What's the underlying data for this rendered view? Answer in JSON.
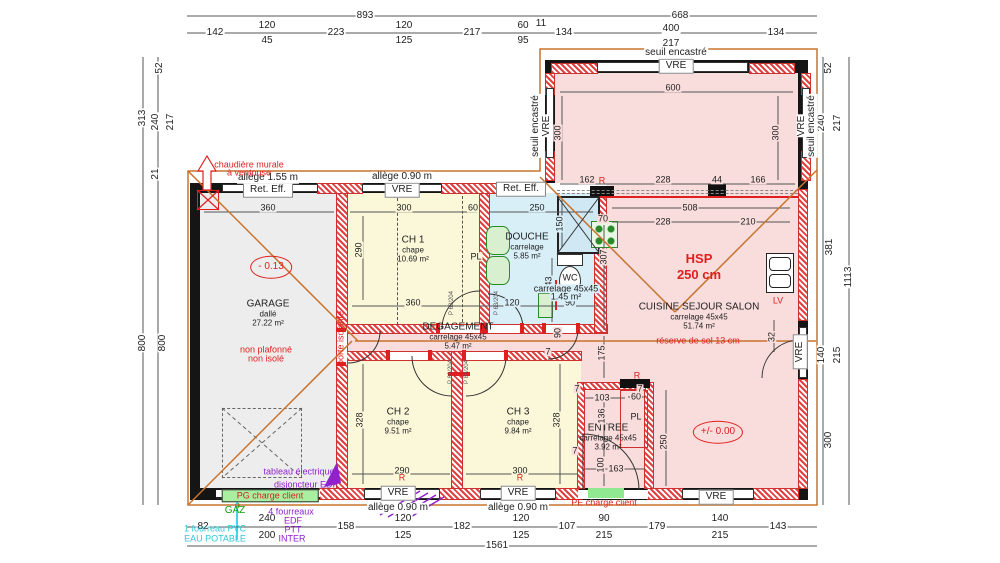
{
  "colors": {
    "wall": "#151515",
    "roof_line": "#c8732d",
    "annotation_red": "#e02020",
    "annotation_purple": "#9020d0",
    "annotation_cyan": "#30c8d8",
    "annotation_green": "#10a010",
    "floor_garage": "#ededed",
    "floor_bedroom": "#fbf7d9",
    "floor_bath": "#d9eff8",
    "floor_living": "#f9dcdc"
  },
  "rooms": [
    {
      "name": "GARAGE",
      "sub": "dallé",
      "area": "27.22 m²",
      "x": 268,
      "y": 313
    },
    {
      "name": "CH 1",
      "sub": "chape",
      "area": "10.69 m²",
      "x": 413,
      "y": 249
    },
    {
      "name": "DOUCHE",
      "sub": "carrelage",
      "area": "5.85 m²",
      "x": 527,
      "y": 246
    },
    {
      "name": "DEGAGEMENT",
      "sub": "carrelage 45x45",
      "area": "5.47 m²",
      "x": 458,
      "y": 336
    },
    {
      "name": "CH 2",
      "sub": "chape",
      "area": "9.51 m²",
      "x": 398,
      "y": 421
    },
    {
      "name": "CH 3",
      "sub": "chape",
      "area": "9.84 m²",
      "x": 518,
      "y": 421
    },
    {
      "name": "ENTREE",
      "sub": "carrelage 45x45",
      "area": "3.92 m²",
      "x": 608,
      "y": 437
    },
    {
      "name": "CUISINE SEJOUR SALON",
      "sub": "carrelage 45x45",
      "area": "51.74 m²",
      "x": 699,
      "y": 316
    }
  ],
  "labels": [
    {
      "t": "893",
      "x": 365,
      "y": 16
    },
    {
      "t": "668",
      "x": 680,
      "y": 16
    },
    {
      "t": "142",
      "x": 215,
      "y": 33
    },
    {
      "t": "120",
      "x": 267,
      "y": 26
    },
    {
      "t": "45",
      "x": 267,
      "y": 41
    },
    {
      "t": "223",
      "x": 336,
      "y": 33
    },
    {
      "t": "120",
      "x": 404,
      "y": 26
    },
    {
      "t": "125",
      "x": 404,
      "y": 41
    },
    {
      "t": "217",
      "x": 472,
      "y": 33
    },
    {
      "t": "60",
      "x": 523,
      "y": 26
    },
    {
      "t": "95",
      "x": 523,
      "y": 41
    },
    {
      "t": "11",
      "x": 541,
      "y": 24
    },
    {
      "t": "134",
      "x": 564,
      "y": 33
    },
    {
      "t": "400",
      "x": 671,
      "y": 29
    },
    {
      "t": "217",
      "x": 671,
      "y": 44
    },
    {
      "t": "134",
      "x": 776,
      "y": 33
    },
    {
      "t": "313",
      "x": 143,
      "y": 118,
      "r": -90
    },
    {
      "t": "800",
      "x": 143,
      "y": 343,
      "r": -90
    },
    {
      "t": "52",
      "x": 160,
      "y": 68,
      "r": -90
    },
    {
      "t": "240",
      "x": 156,
      "y": 122,
      "r": -90
    },
    {
      "t": "217",
      "x": 171,
      "y": 122,
      "r": -90
    },
    {
      "t": "21",
      "x": 156,
      "y": 174,
      "r": -90
    },
    {
      "t": "800",
      "x": 163,
      "y": 343,
      "r": -90
    },
    {
      "t": "52",
      "x": 829,
      "y": 68,
      "r": -90
    },
    {
      "t": "240",
      "x": 822,
      "y": 123,
      "r": -90
    },
    {
      "t": "217",
      "x": 838,
      "y": 123,
      "r": -90
    },
    {
      "t": "381",
      "x": 830,
      "y": 247,
      "r": -90
    },
    {
      "t": "140",
      "x": 822,
      "y": 355,
      "r": -90
    },
    {
      "t": "215",
      "x": 838,
      "y": 355,
      "r": -90
    },
    {
      "t": "300",
      "x": 829,
      "y": 440,
      "r": -90
    },
    {
      "t": "1113",
      "x": 849,
      "y": 277,
      "r": -90
    },
    {
      "t": "82",
      "x": 203,
      "y": 527
    },
    {
      "t": "240",
      "x": 267,
      "y": 519
    },
    {
      "t": "200",
      "x": 267,
      "y": 536
    },
    {
      "t": "158",
      "x": 346,
      "y": 527
    },
    {
      "t": "120",
      "x": 403,
      "y": 519
    },
    {
      "t": "125",
      "x": 403,
      "y": 536
    },
    {
      "t": "182",
      "x": 462,
      "y": 527
    },
    {
      "t": "120",
      "x": 521,
      "y": 519
    },
    {
      "t": "125",
      "x": 521,
      "y": 536
    },
    {
      "t": "107",
      "x": 567,
      "y": 527
    },
    {
      "t": "90",
      "x": 604,
      "y": 519
    },
    {
      "t": "215",
      "x": 604,
      "y": 536
    },
    {
      "t": "179",
      "x": 657,
      "y": 527
    },
    {
      "t": "140",
      "x": 720,
      "y": 519
    },
    {
      "t": "215",
      "x": 720,
      "y": 536
    },
    {
      "t": "143",
      "x": 778,
      "y": 527
    },
    {
      "t": "1561",
      "x": 497,
      "y": 546
    },
    {
      "t": "360",
      "x": 268,
      "y": 208,
      "c": "lb di bgg"
    },
    {
      "t": "300",
      "x": 404,
      "y": 208,
      "c": "lb di bgy"
    },
    {
      "t": "60",
      "x": 473,
      "y": 208,
      "c": "lb di bgy"
    },
    {
      "t": "250",
      "x": 537,
      "y": 208,
      "c": "lb di bgb"
    },
    {
      "t": "70",
      "x": 603,
      "y": 219,
      "c": "lb di bgp"
    },
    {
      "t": "290",
      "x": 359,
      "y": 250,
      "r": -90,
      "c": "lb di bgy"
    },
    {
      "t": "150",
      "x": 560,
      "y": 224,
      "r": -90,
      "c": "lb di bgb"
    },
    {
      "t": "307",
      "x": 604,
      "y": 257,
      "r": -90,
      "c": "lb di bgp"
    },
    {
      "t": "143",
      "x": 549,
      "y": 284,
      "r": -90,
      "c": "lb di bgb"
    },
    {
      "t": "120",
      "x": 512,
      "y": 303,
      "c": "lb di bgb"
    },
    {
      "t": "360",
      "x": 413,
      "y": 303,
      "c": "lb di bgy"
    },
    {
      "t": "90",
      "x": 570,
      "y": 303,
      "c": "lb di bgb"
    },
    {
      "t": "90",
      "x": 558,
      "y": 333,
      "r": -90,
      "c": "lb di bgp"
    },
    {
      "t": "175",
      "x": 602,
      "y": 353,
      "r": -90,
      "c": "lb di bgp"
    },
    {
      "t": "600",
      "x": 673,
      "y": 88,
      "c": "lb di bgp"
    },
    {
      "t": "300",
      "x": 558,
      "y": 133,
      "r": -90,
      "c": "lb di bgp"
    },
    {
      "t": "300",
      "x": 776,
      "y": 133,
      "r": -90,
      "c": "lb di bgp"
    },
    {
      "t": "162",
      "x": 587,
      "y": 180,
      "c": "lb di bgp"
    },
    {
      "t": "228",
      "x": 663,
      "y": 180,
      "c": "lb di bgp"
    },
    {
      "t": "44",
      "x": 717,
      "y": 180,
      "c": "lb di bgp"
    },
    {
      "t": "166",
      "x": 758,
      "y": 180,
      "c": "lb di bgp"
    },
    {
      "t": "508",
      "x": 690,
      "y": 208,
      "c": "lb di bgp"
    },
    {
      "t": "228",
      "x": 663,
      "y": 222,
      "c": "lb di bgp"
    },
    {
      "t": "210",
      "x": 748,
      "y": 222,
      "c": "lb di bgp"
    },
    {
      "t": "328",
      "x": 360,
      "y": 420,
      "r": -90,
      "c": "lb di bgy"
    },
    {
      "t": "290",
      "x": 402,
      "y": 471,
      "c": "lb di bgy"
    },
    {
      "t": "328",
      "x": 557,
      "y": 420,
      "r": -90,
      "c": "lb di bgy"
    },
    {
      "t": "300",
      "x": 520,
      "y": 471,
      "c": "lb di bgy"
    },
    {
      "t": "103",
      "x": 602,
      "y": 398,
      "c": "lb di bgp"
    },
    {
      "t": "60",
      "x": 636,
      "y": 397,
      "c": "lb di bgp"
    },
    {
      "t": "136",
      "x": 602,
      "y": 416,
      "r": -90,
      "c": "lb di bgp"
    },
    {
      "t": "250",
      "x": 664,
      "y": 442,
      "r": -90,
      "c": "lb di bgp"
    },
    {
      "t": "100",
      "x": 601,
      "y": 465,
      "r": -90,
      "c": "lb di bgp"
    },
    {
      "t": "163",
      "x": 616,
      "y": 469,
      "c": "lb di bgp"
    },
    {
      "t": "32",
      "x": 772,
      "y": 337,
      "r": -90,
      "c": "lb di bgp"
    },
    {
      "t": "7",
      "x": 577,
      "y": 389,
      "c": "lb di bgp"
    },
    {
      "t": "7",
      "x": 640,
      "y": 389,
      "c": "lb di bgp"
    },
    {
      "t": "7",
      "x": 548,
      "y": 352,
      "c": "lb di bgp"
    },
    {
      "t": "7",
      "x": 575,
      "y": 451,
      "c": "lb di bgp"
    },
    {
      "t": "PL",
      "x": 476,
      "y": 257,
      "c": "lb di bgy"
    },
    {
      "t": "PL",
      "x": 636,
      "y": 417,
      "c": "lb di bgp"
    },
    {
      "t": "carrelage 45x45",
      "x": 566,
      "y": 289,
      "c": "lb di bgb"
    },
    {
      "t": "1.45 m²",
      "x": 566,
      "y": 297,
      "c": "lb di bgb"
    },
    {
      "t": "WC",
      "x": 570,
      "y": 278,
      "c": "lb di",
      "n": "wc-label"
    },
    {
      "t": "VRE",
      "x": 676,
      "y": 66,
      "c": "lb wl",
      "n": "window-label"
    },
    {
      "t": "seuil encastré",
      "x": 676,
      "y": 53
    },
    {
      "t": "Ret. Eff.",
      "x": 268,
      "y": 190,
      "c": "lb wl",
      "n": "window-label"
    },
    {
      "t": "allège 1.55 m",
      "x": 268,
      "y": 178
    },
    {
      "t": "VRE",
      "x": 402,
      "y": 190,
      "c": "lb wl",
      "n": "window-label"
    },
    {
      "t": "allège 0.90 m",
      "x": 402,
      "y": 177
    },
    {
      "t": "Ret. Eff.",
      "x": 521,
      "y": 189,
      "c": "lb wl",
      "n": "window-label"
    },
    {
      "t": "VRE",
      "x": 398,
      "y": 493,
      "c": "lb wl",
      "n": "window-label"
    },
    {
      "t": "allège 0.90 m",
      "x": 398,
      "y": 508
    },
    {
      "t": "VRE",
      "x": 518,
      "y": 493,
      "c": "lb wl",
      "n": "window-label"
    },
    {
      "t": "allège 0.90 m",
      "x": 518,
      "y": 508
    },
    {
      "t": "VRE",
      "x": 716,
      "y": 497,
      "c": "lb wl",
      "n": "window-label"
    },
    {
      "t": "VRE",
      "x": 800,
      "y": 352,
      "r": -90,
      "c": "lb wl",
      "n": "window-label"
    },
    {
      "t": "seuil encastré",
      "x": 536,
      "y": 126,
      "r": -90
    },
    {
      "t": "VRE",
      "x": 547,
      "y": 126,
      "r": -90
    },
    {
      "t": "VRE",
      "x": 802,
      "y": 126,
      "r": -90
    },
    {
      "t": "seuil encastré",
      "x": 812,
      "y": 126,
      "r": -90
    },
    {
      "t": "chaudière murale",
      "x": 249,
      "y": 165,
      "c": "lb red"
    },
    {
      "t": "à ventouse",
      "x": 249,
      "y": 173,
      "c": "lb red"
    },
    {
      "t": "non plafonné",
      "x": 266,
      "y": 350,
      "c": "lb red"
    },
    {
      "t": "non isolé",
      "x": 266,
      "y": 359,
      "c": "lb red"
    },
    {
      "t": "porte isolante",
      "x": 341,
      "y": 338,
      "r": -90,
      "c": "lb red"
    },
    {
      "t": "HSP",
      "x": 699,
      "y": 259,
      "c": "lb hsp"
    },
    {
      "t": "250 cm",
      "x": 699,
      "y": 275,
      "c": "lb hsp"
    },
    {
      "t": "réserve de sol 13 cm",
      "x": 698,
      "y": 341,
      "c": "lb red"
    },
    {
      "t": "LV",
      "x": 778,
      "y": 301,
      "c": "lb red"
    },
    {
      "t": "R",
      "x": 602,
      "y": 181,
      "c": "lb red"
    },
    {
      "t": "R",
      "x": 637,
      "y": 376,
      "c": "lb red"
    },
    {
      "t": "R",
      "x": 402,
      "y": 478,
      "c": "lb red"
    },
    {
      "t": "R",
      "x": 520,
      "y": 478,
      "c": "lb red"
    },
    {
      "t": "PE charge client",
      "x": 604,
      "y": 503,
      "c": "lb red"
    },
    {
      "t": "- 0.13",
      "x": 271,
      "y": 267,
      "c": "lb lvl",
      "n": "level-badge"
    },
    {
      "t": "+/- 0.00",
      "x": 718,
      "y": 432,
      "c": "lb lvl",
      "n": "level-badge"
    },
    {
      "t": "tableau électrique",
      "x": 299,
      "y": 472,
      "c": "lb pur"
    },
    {
      "t": "disjoncteur EDF",
      "x": 306,
      "y": 485,
      "c": "lb pur"
    },
    {
      "t": "4 fourreaux",
      "x": 291,
      "y": 512,
      "c": "lb pur"
    },
    {
      "t": "EDF",
      "x": 293,
      "y": 521,
      "c": "lb pur"
    },
    {
      "t": "PTT",
      "x": 293,
      "y": 530,
      "c": "lb pur"
    },
    {
      "t": "INTER",
      "x": 292,
      "y": 539,
      "c": "lb pur"
    },
    {
      "t": "1 fourreau PVC",
      "x": 215,
      "y": 529,
      "c": "lb cy"
    },
    {
      "t": "EAU POTABLE",
      "x": 215,
      "y": 539,
      "c": "lb cy"
    },
    {
      "t": "GAZ",
      "x": 235,
      "y": 511,
      "c": "lb gr"
    },
    {
      "t": "PG charge client",
      "x": 270,
      "y": 496,
      "c": "lb pg",
      "n": "pg-charge-client"
    },
    {
      "t": "P 63/204",
      "x": 452,
      "y": 303,
      "r": -90,
      "c": "lb code",
      "n": "door-code"
    },
    {
      "t": "P 63/204",
      "x": 497,
      "y": 303,
      "r": -90,
      "c": "lb code",
      "n": "door-code"
    },
    {
      "t": "P 83/204",
      "x": 451,
      "y": 372,
      "r": -90,
      "c": "lb code",
      "n": "door-code"
    },
    {
      "t": "P 83/204",
      "x": 467,
      "y": 372,
      "r": -90,
      "c": "lb code",
      "n": "door-code"
    }
  ]
}
